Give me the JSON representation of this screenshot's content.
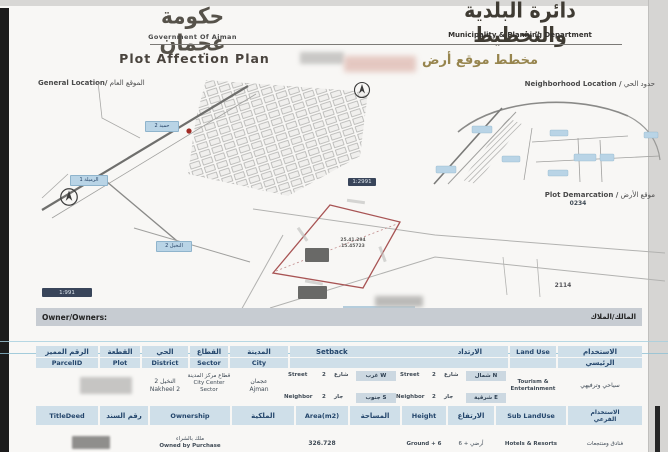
{
  "colors": {
    "table_header_bg": "#cfdfe9",
    "table_header_text": "#23456b",
    "owner_bar_bg": "#c7ccd2",
    "plot_outline_red": "#a85454",
    "arabic_title_tan": "#97854e",
    "map_chip_blue": "#b9d4e6",
    "scale_chip_dark": "#39455a"
  },
  "header": {
    "gov_logo_ar": "حكومة عجمان",
    "gov_logo_en": "Government Of Ajman",
    "dept_logo_ar": "دائرة البلدية والتخطيط",
    "dept_logo_en": "Municipality & Planning Department"
  },
  "titles": {
    "en": "Plot Affection Plan",
    "ar": "مخطط موقع أرض"
  },
  "maps": {
    "general": {
      "label_en": "General Location/",
      "label_ar": "الموقع العام",
      "chip_a": "حميد 2",
      "chip_b": "الرميلة 1",
      "chip_c": "النخيل 2",
      "scale": "1:991"
    },
    "neighborhood": {
      "label_en": "Neighborhood Location /",
      "label_ar": "حدود الحي",
      "scale": "1:2991"
    },
    "demarcation": {
      "label_en": "Plot Demarcation /",
      "label_ar": "موقع الأرض",
      "ref_number": "0234",
      "plot_number": "2114",
      "coords_line1": "25.41.294",
      "coords_line2": "15.45723"
    }
  },
  "owner": {
    "label_en": "Owner/Owners:",
    "label_ar": "المالك/الملاك"
  },
  "table1": {
    "headers": {
      "parcel_ar": "الرقم المميز",
      "parcel_en": "ParcelID",
      "plot_ar": "القطعة",
      "plot_en": "Plot",
      "district_ar": "الحي",
      "district_en": "District",
      "sector_ar": "القطاع",
      "sector_en": "Sector",
      "city_ar": "المدينة",
      "city_en": "City",
      "setback_en": "Setback",
      "setback_ar": "الارتداد",
      "landuse_en": "Land Use",
      "landuse_main_ar_1": "الاستخدام",
      "landuse_main_ar_2": "الرئيسي"
    },
    "row": {
      "district_ar": "النخيل 2",
      "district_en": "Nakheel 2",
      "sector_ar": "قطاع مركز المدينة",
      "sector_en": "City Center Sector",
      "city_ar": "عجمان",
      "city_en": "Ajman",
      "setback_w_en": "Street",
      "setback_w_val": "2",
      "setback_w_ar": "شارع",
      "setback_w_dir": "غرب W",
      "setback_n_en": "Street",
      "setback_n_val": "2",
      "setback_n_ar": "شارع",
      "setback_n_dir": "شمال N",
      "setback_s_en": "Neighbor",
      "setback_s_val": "2",
      "setback_s_ar": "جار",
      "setback_s_dir": "جنوب S",
      "setback_e_en": "Neighbor",
      "setback_e_val": "2",
      "setback_e_ar": "جار",
      "setback_e_dir": "شرقية E",
      "landuse_en": "Tourism & Entertainment",
      "landuse_ar": "سياحي وترفيهي"
    }
  },
  "table2": {
    "headers": {
      "titledeed_en": "TitleDeed",
      "titledeed_ar": "رقم السند",
      "ownership_en": "Ownership",
      "ownership_ar": "الملكية",
      "area_en": "Area(m2)",
      "area_ar": "المساحة",
      "height_en": "Height",
      "height_ar": "الارتفاع",
      "sub_en": "Sub LandUse",
      "sub_ar_1": "الاستخدام",
      "sub_ar_2": "الفرعي"
    },
    "row": {
      "ownership_ar": "ملك بالشراء",
      "ownership_en": "Owned by Purchase",
      "area": "326.728",
      "height_en": "Ground + 6",
      "height_ar": "أرضي + 6",
      "sub_en": "Hotels & Resorts",
      "sub_ar": "فنادق ومنتجعات"
    }
  }
}
